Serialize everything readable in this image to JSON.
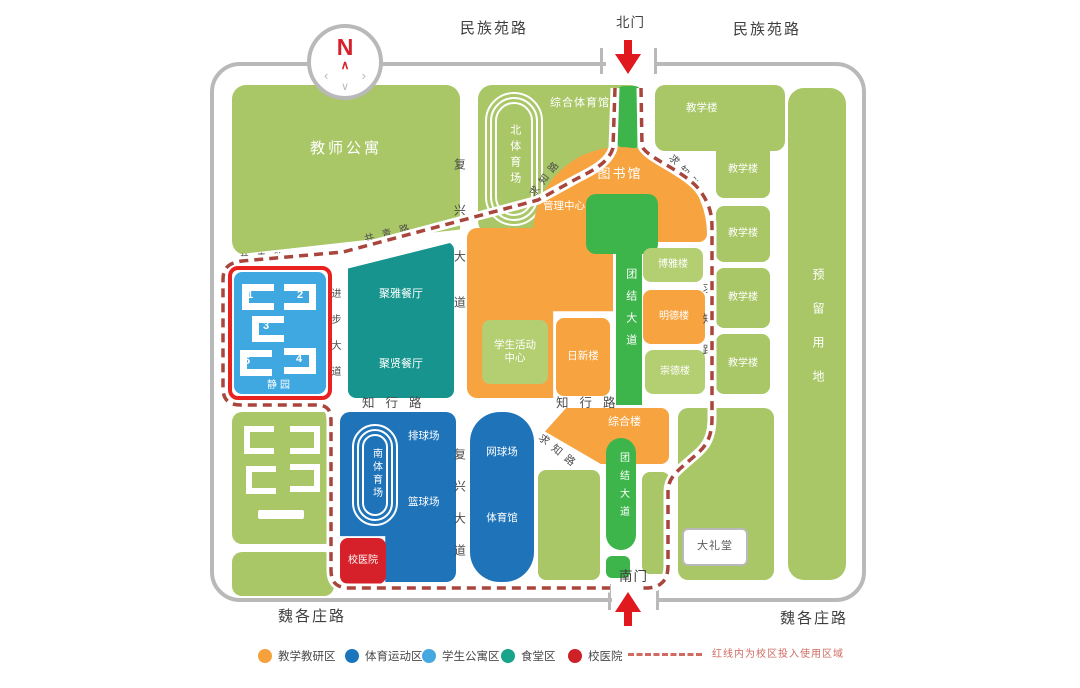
{
  "palette": {
    "light_green": "#a9c767",
    "lighter_green": "#b4cf72",
    "orange": "#f7a440",
    "road_green": "#3db54a",
    "teal": "#16948d",
    "sport_blue": "#1e73b9",
    "apartment_blue": "#3fa8e1",
    "hospital_red": "#d6212b",
    "red_line": "#e8231f",
    "dashed_red": "#a8453c",
    "legend_note_red": "#cf6b60",
    "border_gray": "#b9b9b9"
  },
  "compass": {
    "north": "N"
  },
  "outer_roads": {
    "top_left": "民族苑路",
    "top_right": "民族苑路",
    "bottom_left": "魏各庄路",
    "bottom_right": "魏各庄路"
  },
  "gates": {
    "north": "北门",
    "south": "南门"
  },
  "inner_roads": {
    "fuxing_upper": "复兴大道",
    "fuxing_lower": "复兴大道",
    "zhixing_left": "知行路",
    "zhixing_right": "知行路",
    "jinbu": "进步大道",
    "tuanjie_upper": "团结大道",
    "tuanjie_lower": "团结大道",
    "qiuzhi_arch_left": "求知路",
    "qiuzhi_arch_right": "求知路",
    "qiuzhi_east": "求知路",
    "qiuzhi_diag": "求知路",
    "gongqing_top": "共青路",
    "gongqing_diag": "共青路"
  },
  "blocks": {
    "teacher_apartment": "教师公寓",
    "north_stadium": "北体育场",
    "gymnasium": "综合体育馆",
    "library": "图书馆",
    "management_center": "管理中心",
    "student_activity_center": "学生活动中心",
    "rixin_building": "日新楼",
    "boya_building": "博雅楼",
    "mingde_building": "明德楼",
    "chongde_building": "崇德楼",
    "teaching_buildings": [
      "教学楼",
      "教学楼",
      "教学楼",
      "教学楼",
      "教学楼"
    ],
    "reserved_land": "预留用地",
    "auditorium": "大礼堂",
    "canteen_north": "聚雅餐厅",
    "canteen_south": "聚贤餐厅",
    "complex_building": "综合楼",
    "south_stadium": "南体育场",
    "volleyball": "排球场",
    "basketball": "篮球场",
    "tennis": "网球场",
    "sports_hall": "体育馆",
    "hospital": "校医院",
    "jingyuan": "静园",
    "jingyuan_numbers": [
      "1",
      "2",
      "3",
      "5",
      "4"
    ]
  },
  "legend": {
    "items": [
      {
        "label": "教学教研区",
        "color": "#f6a13c"
      },
      {
        "label": "体育运动区",
        "color": "#1b75bb"
      },
      {
        "label": "学生公寓区",
        "color": "#45a8e0"
      },
      {
        "label": "食堂区",
        "color": "#18a38b"
      },
      {
        "label": "校医院",
        "color": "#cc2127"
      }
    ],
    "note": "红线内为校区投入使用区域"
  }
}
